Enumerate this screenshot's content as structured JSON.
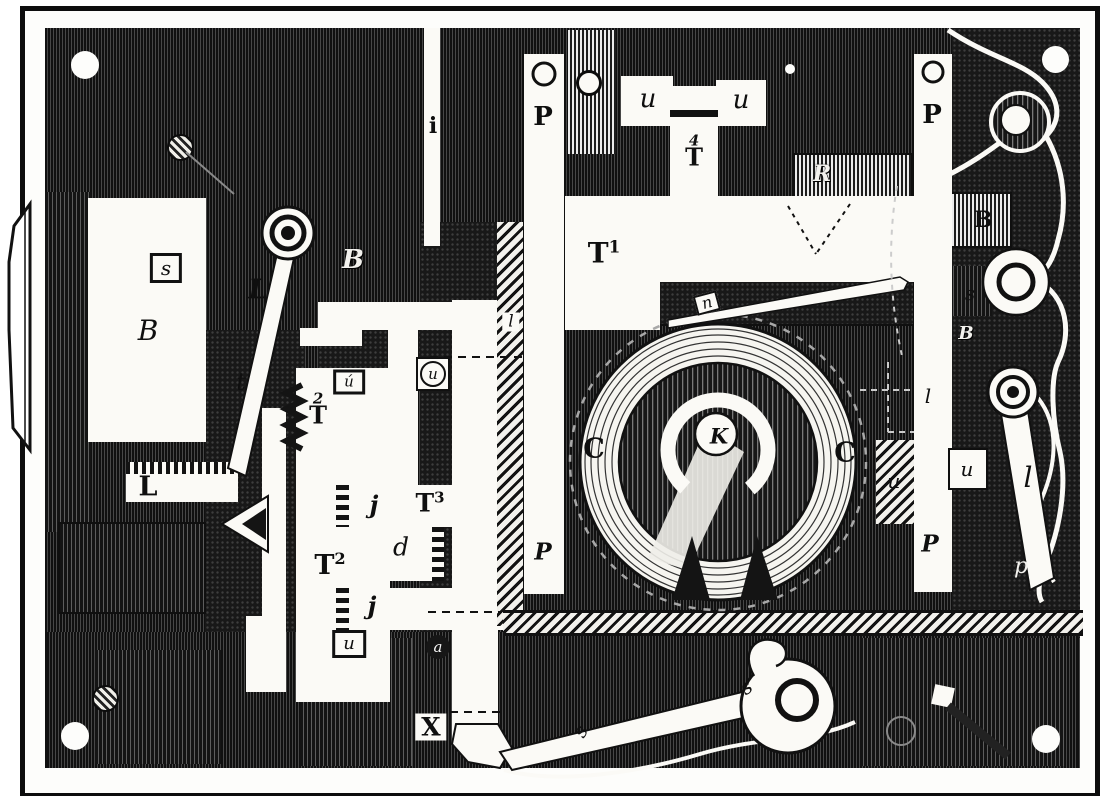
{
  "figure": {
    "kind": "antique-engraving-mechanism-plate",
    "description": "Engraved technical illustration of a lock/telegraph-style mechanism plate with lettered parts"
  },
  "colors": {
    "ink": "#111111",
    "paper": "#fbfaf6",
    "engraving_gray": "#5d5d5d"
  },
  "labels": [
    {
      "id": "s-magnet",
      "text": "s",
      "style": "italic boxed",
      "x": 166,
      "y": 268,
      "size": 20
    },
    {
      "id": "B-magnet",
      "text": "B",
      "style": "italic",
      "x": 148,
      "y": 331,
      "size": 28
    },
    {
      "id": "L-lever",
      "text": "L",
      "style": "bold-italic",
      "x": 258,
      "y": 290,
      "size": 27
    },
    {
      "id": "B-script-left",
      "text": "B",
      "style": "script white",
      "x": 353,
      "y": 260,
      "size": 26
    },
    {
      "id": "t-lever",
      "text": "t",
      "style": "italic",
      "x": 241,
      "y": 382,
      "size": 24
    },
    {
      "id": "T2-upper",
      "text": "T",
      "sup": "2",
      "supAbove": true,
      "style": "bold",
      "x": 318,
      "y": 404,
      "size": 24
    },
    {
      "id": "u-accent",
      "text": "ú",
      "style": "italic boxed",
      "x": 349,
      "y": 382,
      "size": 15
    },
    {
      "id": "u-circled",
      "text": "u",
      "style": "italic circled",
      "x": 433,
      "y": 374,
      "size": 15
    },
    {
      "id": "l-small",
      "text": "l",
      "style": "italic chipw",
      "x": 511,
      "y": 322,
      "size": 17
    },
    {
      "id": "i-rod",
      "text": "i",
      "style": "bold",
      "x": 433,
      "y": 126,
      "size": 22
    },
    {
      "id": "P-left-top",
      "text": "P",
      "style": "bold",
      "x": 543,
      "y": 117,
      "size": 26
    },
    {
      "id": "P-left-bottom",
      "text": "P",
      "style": "bold-italic",
      "x": 543,
      "y": 552,
      "size": 23
    },
    {
      "id": "u-top-left",
      "text": "u",
      "style": "italic",
      "x": 648,
      "y": 99,
      "size": 26
    },
    {
      "id": "u-top-right",
      "text": "u",
      "style": "italic",
      "x": 741,
      "y": 100,
      "size": 26
    },
    {
      "id": "T4",
      "text": "T",
      "sup": "4",
      "supAbove": true,
      "style": "bold",
      "x": 694,
      "y": 146,
      "size": 24
    },
    {
      "id": "T1",
      "text": "T",
      "sup": "1",
      "style": "bold",
      "x": 604,
      "y": 253,
      "size": 28
    },
    {
      "id": "n-needle",
      "text": "n",
      "style": "italic chip",
      "x": 707,
      "y": 303,
      "size": 16,
      "rotate": -15
    },
    {
      "id": "R-script",
      "text": "R",
      "style": "script white",
      "x": 822,
      "y": 174,
      "size": 22
    },
    {
      "id": "P-right-top",
      "text": "P",
      "style": "bold",
      "x": 932,
      "y": 115,
      "size": 26
    },
    {
      "id": "B-right",
      "text": "B",
      "style": "bold",
      "x": 983,
      "y": 220,
      "size": 22
    },
    {
      "id": "s-right",
      "text": "s",
      "style": "italic",
      "x": 970,
      "y": 293,
      "size": 20
    },
    {
      "id": "B-script-right",
      "text": "B",
      "style": "script white",
      "x": 966,
      "y": 334,
      "size": 18
    },
    {
      "id": "l-dashed",
      "text": "l",
      "style": "italic",
      "x": 928,
      "y": 396,
      "size": 20
    },
    {
      "id": "u-right",
      "text": "u",
      "style": "italic",
      "x": 967,
      "y": 469,
      "size": 20
    },
    {
      "id": "u-hatch",
      "text": "u",
      "style": "italic",
      "x": 894,
      "y": 481,
      "size": 20
    },
    {
      "id": "P-right-bottom",
      "text": "P",
      "style": "bold-italic",
      "x": 930,
      "y": 544,
      "size": 23
    },
    {
      "id": "l-arm",
      "text": "l",
      "style": "italic",
      "x": 1028,
      "y": 478,
      "size": 28
    },
    {
      "id": "p-right",
      "text": "p",
      "style": "italic white",
      "x": 1021,
      "y": 567,
      "size": 22
    },
    {
      "id": "C-left",
      "text": "C",
      "style": "bold",
      "x": 594,
      "y": 449,
      "size": 27
    },
    {
      "id": "C-right",
      "text": "C",
      "style": "bold",
      "x": 845,
      "y": 453,
      "size": 27
    },
    {
      "id": "K-center",
      "text": "K",
      "style": "bold-italic",
      "x": 719,
      "y": 436,
      "size": 21
    },
    {
      "id": "j-upper",
      "text": "j",
      "style": "bold-italic",
      "x": 374,
      "y": 505,
      "size": 24
    },
    {
      "id": "T3",
      "text": "T",
      "sup": "3",
      "style": "bold",
      "x": 430,
      "y": 503,
      "size": 25
    },
    {
      "id": "d-rack",
      "text": "d",
      "style": "italic",
      "x": 401,
      "y": 547,
      "size": 25
    },
    {
      "id": "T2-lower",
      "text": "T",
      "sup": "2",
      "style": "bold",
      "x": 330,
      "y": 565,
      "size": 27
    },
    {
      "id": "j-lower",
      "text": "j",
      "style": "bold-italic",
      "x": 372,
      "y": 606,
      "size": 24
    },
    {
      "id": "u-bottom",
      "text": "u",
      "style": "italic boxed",
      "x": 349,
      "y": 644,
      "size": 18
    },
    {
      "id": "a-pivot",
      "text": "a",
      "style": "italic disc",
      "x": 438,
      "y": 647,
      "size": 15
    },
    {
      "id": "L-bottom",
      "text": "L",
      "style": "bold",
      "x": 148,
      "y": 487,
      "size": 27
    },
    {
      "id": "X-bottom",
      "text": "X",
      "style": "bold chipw",
      "x": 431,
      "y": 727,
      "size": 25
    },
    {
      "id": "s-arm",
      "text": "s",
      "style": "italic",
      "x": 580,
      "y": 731,
      "size": 20,
      "rotate": -60
    },
    {
      "id": "s-loop",
      "text": "s",
      "style": "italic",
      "x": 746,
      "y": 687,
      "size": 20,
      "rotate": -35
    }
  ]
}
